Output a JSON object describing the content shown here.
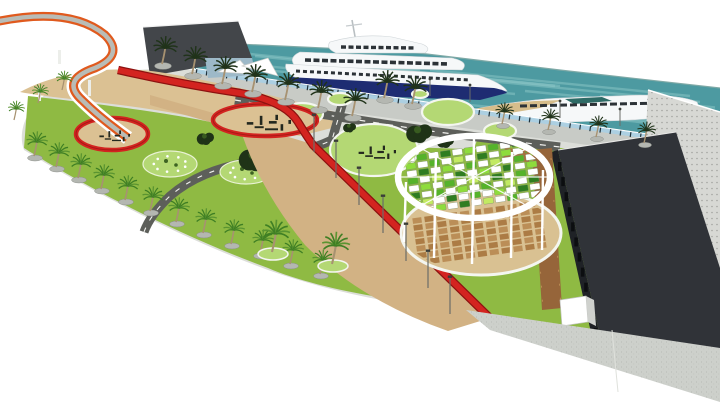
{
  "scene": {
    "type": "3d-architectural-render",
    "subject": "waterfront-marina-park-masterplan"
  },
  "colors": {
    "bg": "#ffffff",
    "water": "#4d9aa1",
    "waterLight": "#8ec8c8",
    "waterEdge": "#7fa9a6",
    "quay": "#c8cbc6",
    "fenceGlass": "#a9d0e4",
    "fencePost": "#20313a",
    "plaza": "#dcded9",
    "speckDot": "#b8bbb4",
    "road": "#5d5f5a",
    "roadLine": "#f2f2ef",
    "lawn": "#8fba43",
    "lawnLight": "#b4d874",
    "ringWhite": "#f4f6f0",
    "sand": "#dbc193",
    "tan": "#d2b284",
    "deckTan": "#d9c192",
    "deckBrown": "#a8763f",
    "deckBrown2": "#b98a52",
    "tileBrown": "#96653a",
    "red": "#d32420",
    "redDark": "#8c1210",
    "orange": "#e05a1e",
    "rampGray": "#b9bcb6",
    "bldgDarkL": "#43464a",
    "bldgDarkR": "#303338",
    "bldgDarkR2": "#1f2226",
    "bldgLight": "#d7d8d4",
    "windowDot": "#9fa09c",
    "hullNavy": "#1e2c72",
    "yachtWhite": "#f6f8f9",
    "yachtGray": "#cfd5d8",
    "yachtWin": "#2c3237",
    "yachtTan": "#d6bd8b",
    "glassTeal": "#2e6b66",
    "palmGreen": "#3f7f24",
    "palmLite": "#5a9431",
    "palmDark": "#20331a",
    "trunk": "#a79271",
    "pad": "#b4b7b1",
    "padDark": "#8e918c",
    "treeDark": "#1f3317",
    "treeLite": "#3d6322",
    "equip": "#23281f",
    "pole": "#6a6d68"
  },
  "water_streaks": [
    {
      "x": 210,
      "y": 50,
      "len": 210
    },
    {
      "x": 255,
      "y": 56,
      "len": 300
    },
    {
      "x": 225,
      "y": 62,
      "len": 150
    },
    {
      "x": 310,
      "y": 61,
      "len": 250
    },
    {
      "x": 430,
      "y": 70,
      "len": 260
    },
    {
      "x": 480,
      "y": 80,
      "len": 220
    },
    {
      "x": 525,
      "y": 91,
      "len": 180
    },
    {
      "x": 245,
      "y": 68,
      "len": 120
    },
    {
      "x": 355,
      "y": 78,
      "len": 160
    },
    {
      "x": 600,
      "y": 96,
      "len": 115
    },
    {
      "x": 305,
      "y": 88,
      "len": 145
    },
    {
      "x": 520,
      "y": 108,
      "len": 175
    },
    {
      "x": 600,
      "y": 118,
      "len": 118
    },
    {
      "x": 420,
      "y": 100,
      "len": 130
    }
  ],
  "palms": {
    "curveRow": [
      [
        34,
        156
      ],
      [
        56,
        167
      ],
      [
        78,
        178
      ],
      [
        101,
        189
      ],
      [
        125,
        200
      ],
      [
        150,
        211
      ],
      [
        176,
        222
      ],
      [
        203,
        233
      ],
      [
        231,
        244
      ],
      [
        260,
        254
      ],
      [
        290,
        264
      ],
      [
        320,
        274
      ]
    ],
    "promenade": [
      [
        162,
        64
      ],
      [
        192,
        74
      ],
      [
        222,
        84
      ],
      [
        252,
        92
      ],
      [
        285,
        100
      ],
      [
        318,
        108
      ],
      [
        352,
        116
      ],
      [
        384,
        98
      ],
      [
        412,
        104
      ]
    ],
    "quayRight": [
      [
        502,
        124
      ],
      [
        548,
        130
      ],
      [
        596,
        137
      ],
      [
        644,
        143
      ]
    ],
    "plaza": [
      [
        272,
        252
      ],
      [
        332,
        264
      ]
    ],
    "leftSmall": [
      [
        14,
        120
      ],
      [
        38,
        103
      ],
      [
        62,
        90
      ]
    ]
  },
  "green_circles": [
    [
      302,
      114,
      21,
      11
    ],
    [
      340,
      99,
      12,
      6
    ],
    [
      374,
      150,
      44,
      26
    ],
    [
      448,
      112,
      26,
      13
    ],
    [
      500,
      131,
      16,
      8
    ],
    [
      420,
      94,
      8,
      4
    ]
  ],
  "flower_circles": [
    [
      170,
      164,
      27,
      13
    ],
    [
      246,
      172,
      26,
      12
    ],
    [
      293,
      194,
      18,
      9
    ]
  ],
  "tree_clusters": [
    [
      256,
      160,
      15
    ],
    [
      206,
      139,
      8
    ],
    [
      420,
      134,
      12
    ],
    [
      446,
      142,
      8
    ],
    [
      350,
      128,
      6
    ],
    [
      296,
      128,
      5
    ]
  ],
  "playgrounds": [
    [
      112,
      134,
      36,
      16
    ],
    [
      265,
      120,
      52,
      16
    ],
    [
      374,
      150,
      44,
      26
    ]
  ],
  "lamp_posts": [
    [
      314,
      152
    ],
    [
      336,
      178
    ],
    [
      359,
      205
    ],
    [
      383,
      233
    ],
    [
      406,
      261
    ],
    [
      428,
      288
    ],
    [
      450,
      314
    ]
  ],
  "mini_lamps": [
    [
      430,
      96
    ],
    [
      470,
      102
    ],
    [
      560,
      118
    ],
    [
      620,
      126
    ]
  ],
  "canopy": {
    "cx": 474,
    "cy": 177,
    "rx": 76,
    "ry": 41,
    "panel_palette": [
      "#ffffff",
      "#2f7d21",
      "#55b32a",
      "#8edc3c",
      "#c2ea62"
    ],
    "panel_grid": [
      [
        0,
        2,
        0,
        1,
        0,
        3,
        0,
        2,
        0,
        1,
        0
      ],
      [
        3,
        0,
        2,
        0,
        4,
        0,
        1,
        0,
        3,
        0,
        2
      ],
      [
        0,
        1,
        0,
        3,
        0,
        2,
        0,
        4,
        0,
        2,
        0
      ],
      [
        2,
        0,
        4,
        0,
        1,
        0,
        3,
        0,
        1,
        0,
        3
      ],
      [
        0,
        3,
        0,
        2,
        0,
        4,
        0,
        1,
        0,
        2,
        0
      ],
      [
        1,
        0,
        2,
        0,
        3,
        0,
        2,
        0,
        4,
        0,
        1
      ],
      [
        0,
        4,
        0,
        1,
        0,
        2,
        0,
        3,
        0,
        1,
        0
      ],
      [
        2,
        0,
        3,
        0,
        1,
        0,
        4,
        0,
        2,
        0,
        0
      ]
    ],
    "masts": [
      [
        406,
        182,
        404,
        242
      ],
      [
        436,
        152,
        434,
        258
      ],
      [
        474,
        138,
        472,
        264
      ],
      [
        512,
        152,
        511,
        258
      ],
      [
        543,
        170,
        542,
        250
      ]
    ]
  },
  "deck": {
    "cx": 481,
    "cy": 233,
    "rx": 80,
    "ry": 42,
    "rows": 7,
    "cols": 11
  },
  "slab_window_slits": 12
}
